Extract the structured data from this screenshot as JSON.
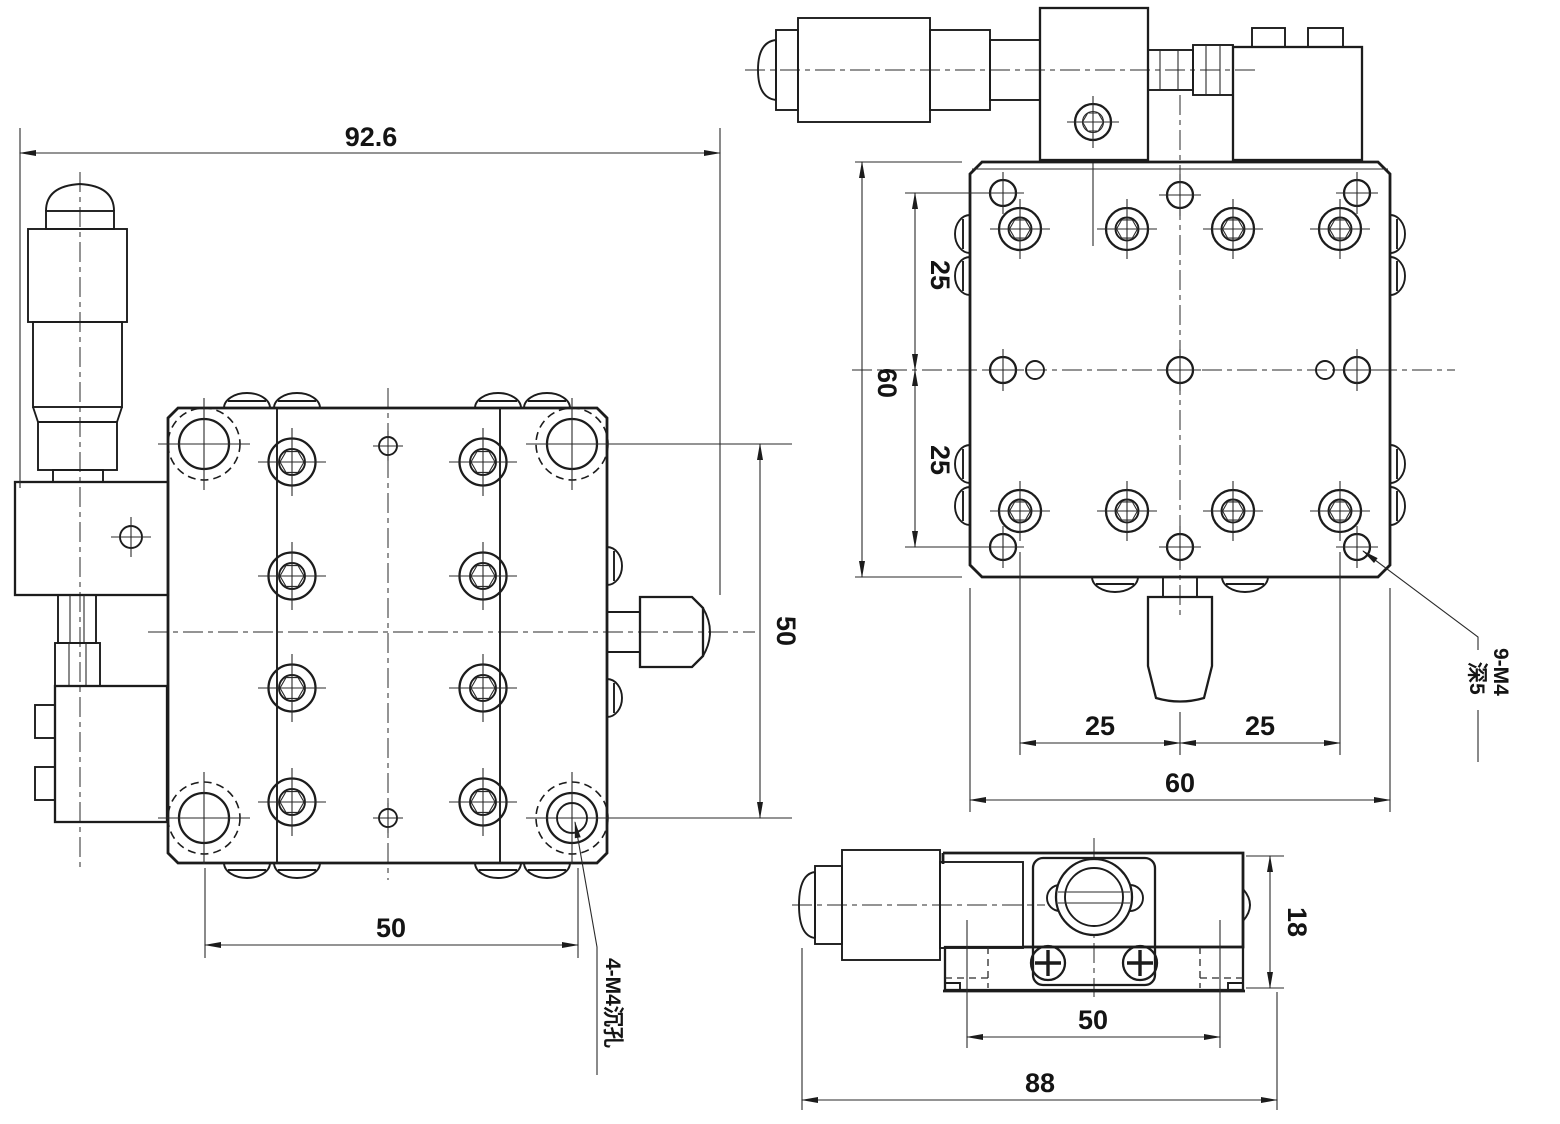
{
  "drawing": {
    "kind": "mechanical-engineering-drawing",
    "views": [
      "front",
      "top",
      "side"
    ],
    "colors": {
      "line": "#1c1c1c",
      "background": "#ffffff"
    },
    "dims": {
      "front_width": "92.6",
      "front_hole_spacing_x": "50",
      "front_hole_spacing_y": "50",
      "top_plate_height": "60",
      "top_row_offset_upper": "25",
      "top_row_offset_lower": "25",
      "top_col_offset_left": "25",
      "top_col_offset_right": "25",
      "top_plate_width": "60",
      "side_height": "18",
      "side_hole_spacing": "50",
      "side_length": "88"
    },
    "annotations": {
      "counterbore": "4-M4沉孔",
      "tapped_line1": "9-M4",
      "tapped_line2": "深5"
    }
  }
}
